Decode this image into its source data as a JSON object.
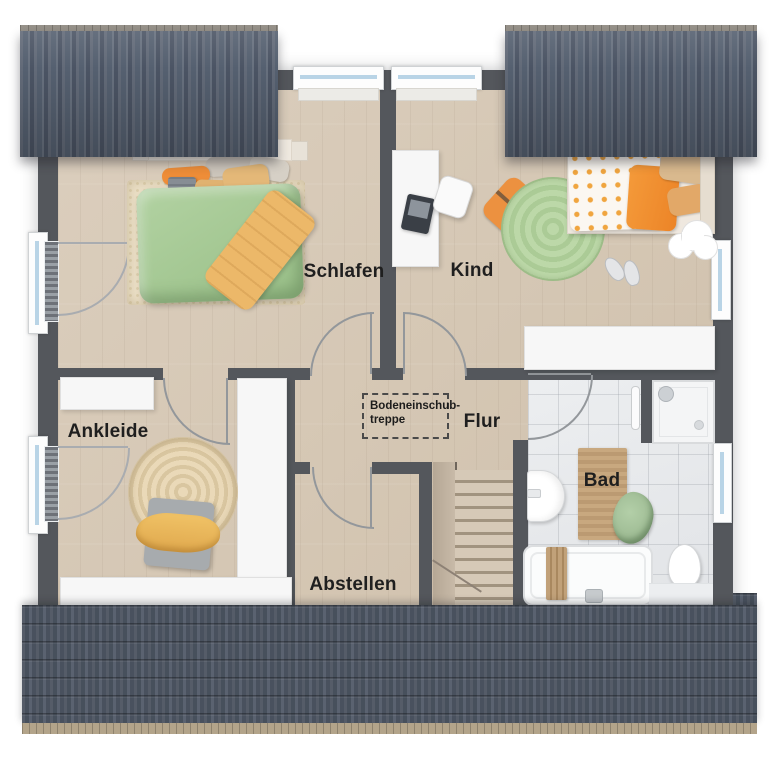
{
  "rooms": {
    "schlafen": {
      "label": "Schlafen"
    },
    "kind": {
      "label": "Kind"
    },
    "ankleide": {
      "label": "Ankleide"
    },
    "flur": {
      "label": "Flur"
    },
    "bad": {
      "label": "Bad"
    },
    "abstellen": {
      "label": "Abstellen"
    }
  },
  "annotation": {
    "attic_stair_line1": "Bodeneinschub-",
    "attic_stair_line2": "treppe"
  },
  "colors": {
    "wall": "#54575c",
    "wood_floor": "#d5c7b4",
    "tile_floor": "#e6e7e9",
    "roof_top": "#59616f",
    "roof_bottom": "#4e5560",
    "gutter": "#b3a48a",
    "window_glass": "#b9d4e6",
    "accent_orange": "#ec9140",
    "accent_green": "#abce9c",
    "label_text": "#1f1f1f"
  }
}
